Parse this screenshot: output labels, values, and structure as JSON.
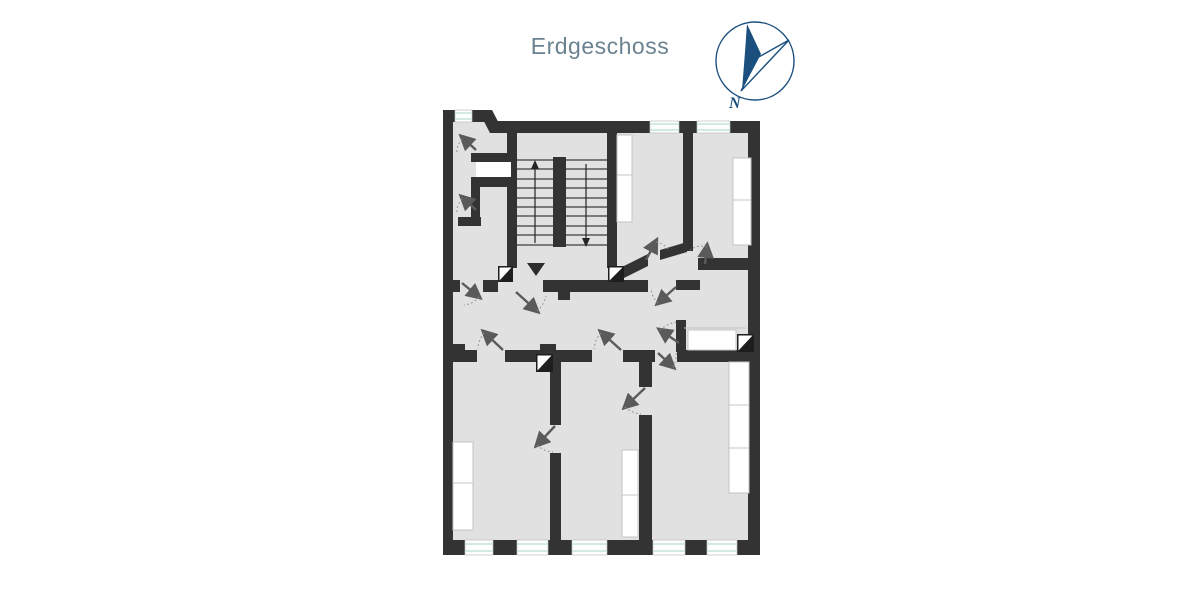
{
  "page": {
    "background": "#ffffff"
  },
  "header": {
    "title": "Erdgeschoss"
  },
  "compass": {
    "north_label": "N",
    "icon": "north-compass-icon"
  },
  "floor_plan": {
    "stairs": {
      "flights": 2,
      "treads_per_flight": 10,
      "direction_arrows": [
        "up",
        "down"
      ],
      "up_icon": "stair-up-arrow-icon",
      "down_icon": "stair-down-arrow-icon"
    },
    "window_count": 8,
    "door_count": 13,
    "chimney_count": 4,
    "entrance_icon": "entrance-triangle-marker"
  },
  "colors": {
    "background": "#ffffff",
    "title": "#6b8290",
    "compass": "#1b4f7e",
    "wall": "#333333",
    "floor": "#e1e1e1",
    "window-line": "#cde7df",
    "stair-line": "#3d3d3d",
    "door": "#5a5a5a",
    "arc": "#8a8a8a",
    "furniture-border": "#c4c4c4"
  }
}
